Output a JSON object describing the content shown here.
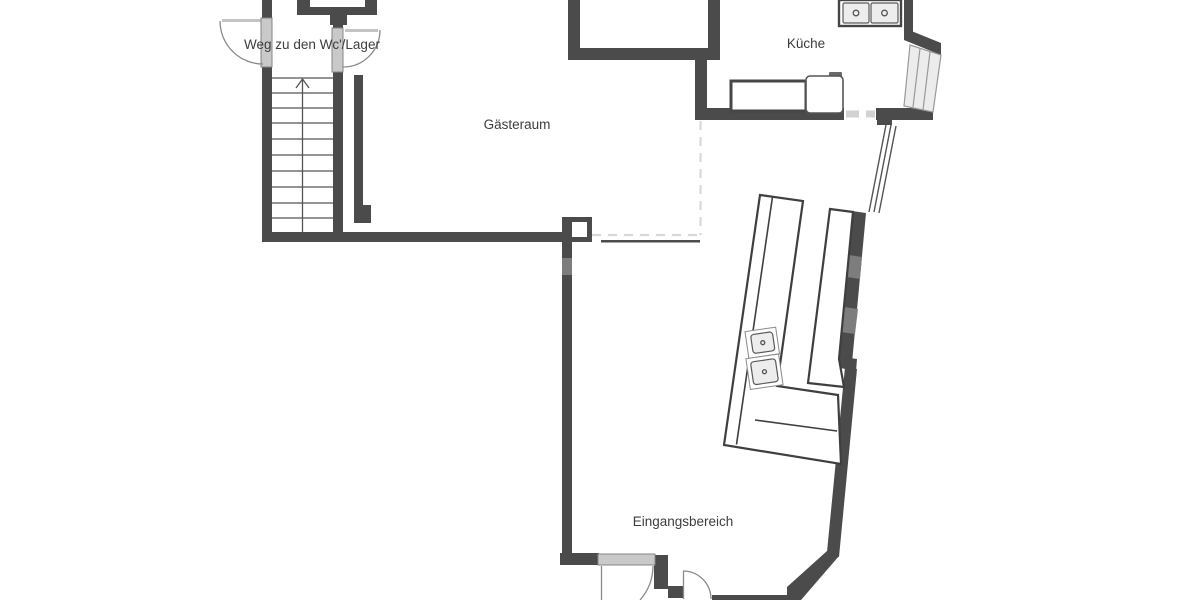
{
  "floorplan": {
    "type": "restaurant-ground-floor",
    "rooms": [
      {
        "id": "weg-wc-lager",
        "label": "Weg zu den Wc'/Lager"
      },
      {
        "id": "gaesteraum",
        "label": "Gästeraum"
      },
      {
        "id": "kueche",
        "label": "Küche"
      },
      {
        "id": "eingangsbereich",
        "label": "Eingangsbereich"
      }
    ],
    "fixtures": [
      {
        "id": "staircase",
        "description": "straight stair, arrow up, 10 treads"
      },
      {
        "id": "kitchen-double-sink",
        "basins": 2
      },
      {
        "id": "kitchen-counter",
        "description": "worktop"
      },
      {
        "id": "kitchen-appliance",
        "description": "rounded appliance with handle"
      },
      {
        "id": "bar-counter",
        "description": "L-shaped tilted counter with 2 sinks"
      },
      {
        "id": "back-counter",
        "description": "tilted back counter along window wall"
      },
      {
        "id": "entrance-door",
        "description": "outer door with swing arc"
      },
      {
        "id": "vestibule-door",
        "description": "inner door with swing arc"
      }
    ],
    "colors": {
      "wall": "#4b4b4b",
      "window": "#7d7d7d",
      "door_leaf": "#c9c9c9",
      "open_boundary_dash": "#d8d8d8",
      "fixture_fill": "#ededed",
      "text": "#3d3d3d",
      "background": "#ffffff"
    }
  }
}
